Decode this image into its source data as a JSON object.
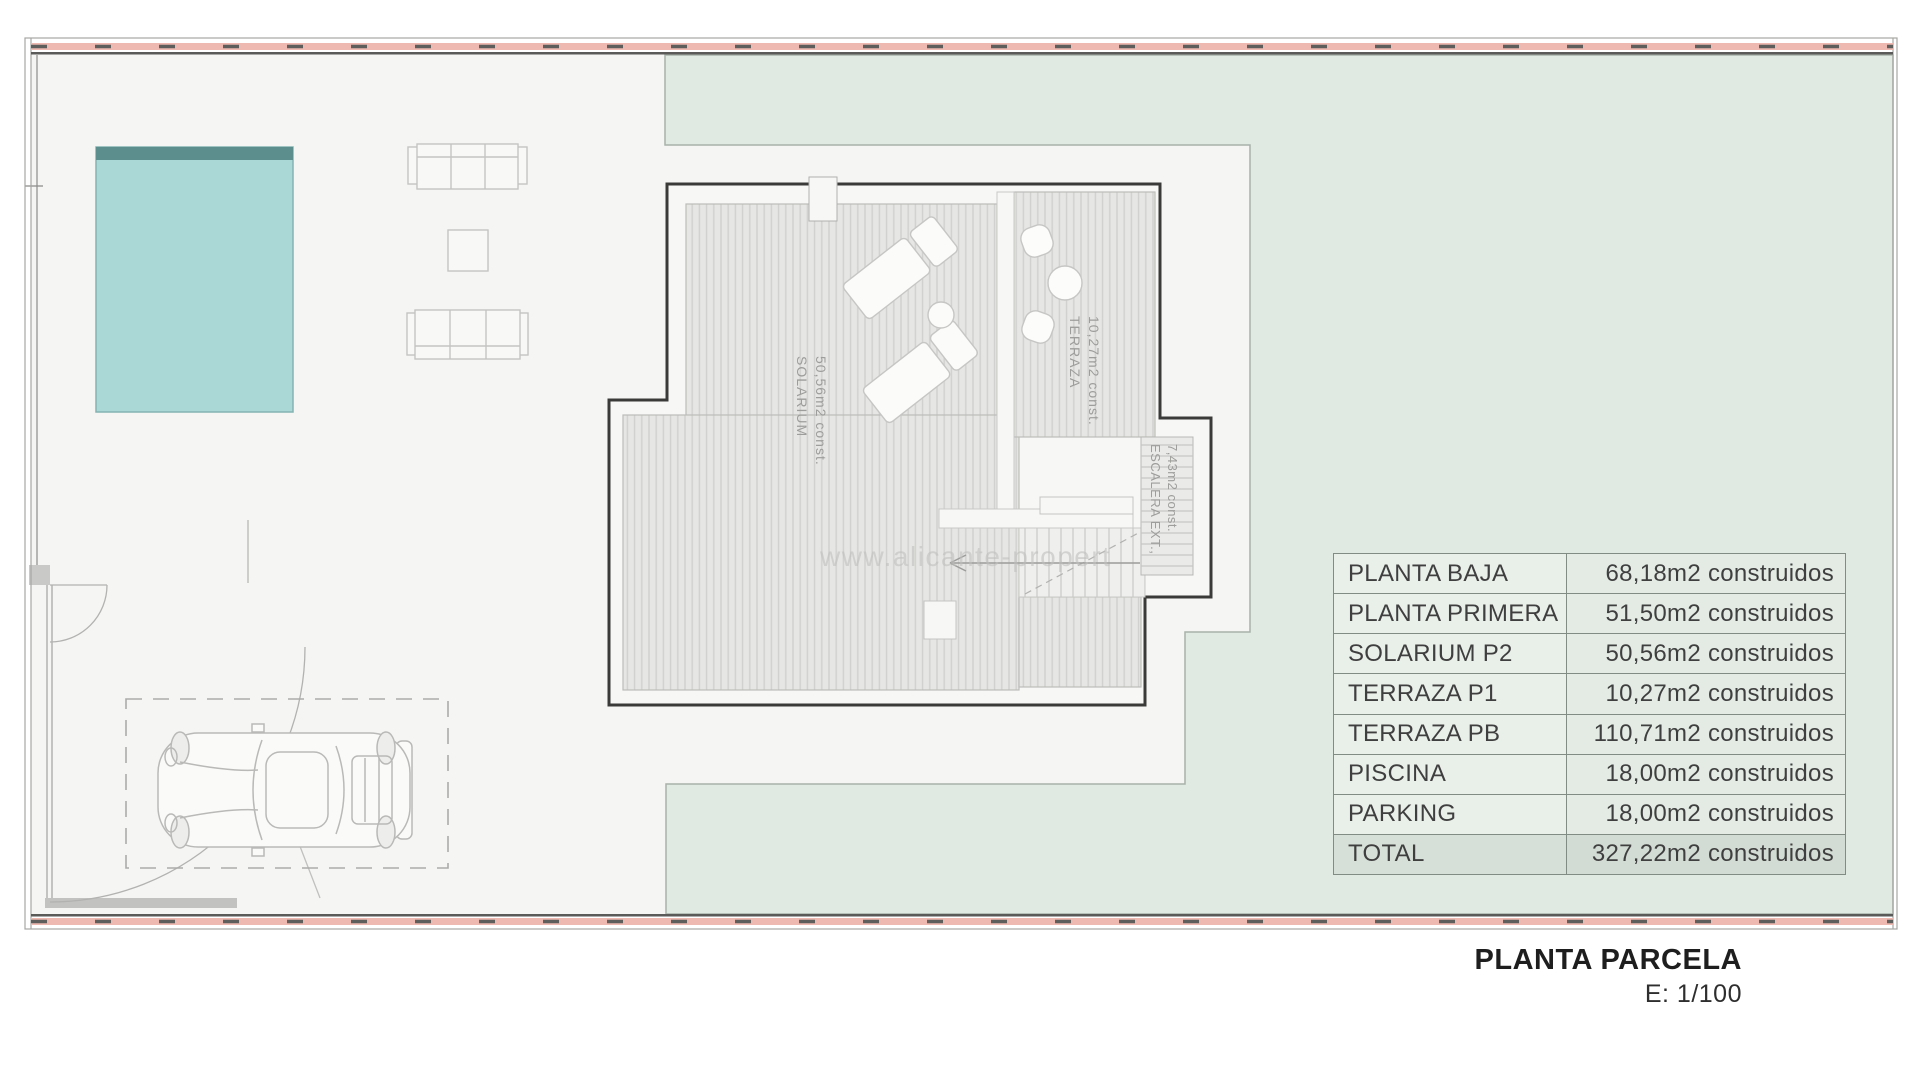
{
  "title": {
    "main": "PLANTA PARCELA",
    "scale": "E: 1/100"
  },
  "area_table": {
    "rows": [
      {
        "label": "PLANTA BAJA",
        "value": "68,18m2 construidos"
      },
      {
        "label": "PLANTA PRIMERA",
        "value": "51,50m2 construidos"
      },
      {
        "label": "SOLARIUM P2",
        "value": "50,56m2 construidos"
      },
      {
        "label": "TERRAZA P1",
        "value": "10,27m2 construidos"
      },
      {
        "label": "TERRAZA PB",
        "value": "110,71m2 construidos"
      },
      {
        "label": "PISCINA",
        "value": "18,00m2 construidos"
      },
      {
        "label": "PARKING",
        "value": "18,00m2 construidos"
      },
      {
        "label": "TOTAL",
        "value": "327,22m2 construidos"
      }
    ]
  },
  "plan": {
    "labels": {
      "solarium": [
        "SOLARIUM",
        "50,56m2 const."
      ],
      "terraza": [
        "TERRAZA",
        "10,27m2 const."
      ],
      "escalera": [
        "ESCALERA EXT.,",
        "7,43m2 const."
      ]
    },
    "watermark": "www.alicante-propert"
  },
  "colors": {
    "garden": "#e0e9e2",
    "paper": "#f5f5f3",
    "pool": "#aad8d7",
    "pool-edge": "#5c8e8e",
    "frame-band": "#edb9b1",
    "table-label": "#e9efe9",
    "table-value": "#e3ebe4",
    "table-total-label": "#d7e0d8",
    "table-total-value": "#d3dcd4",
    "ink": "#3f3f3f"
  }
}
